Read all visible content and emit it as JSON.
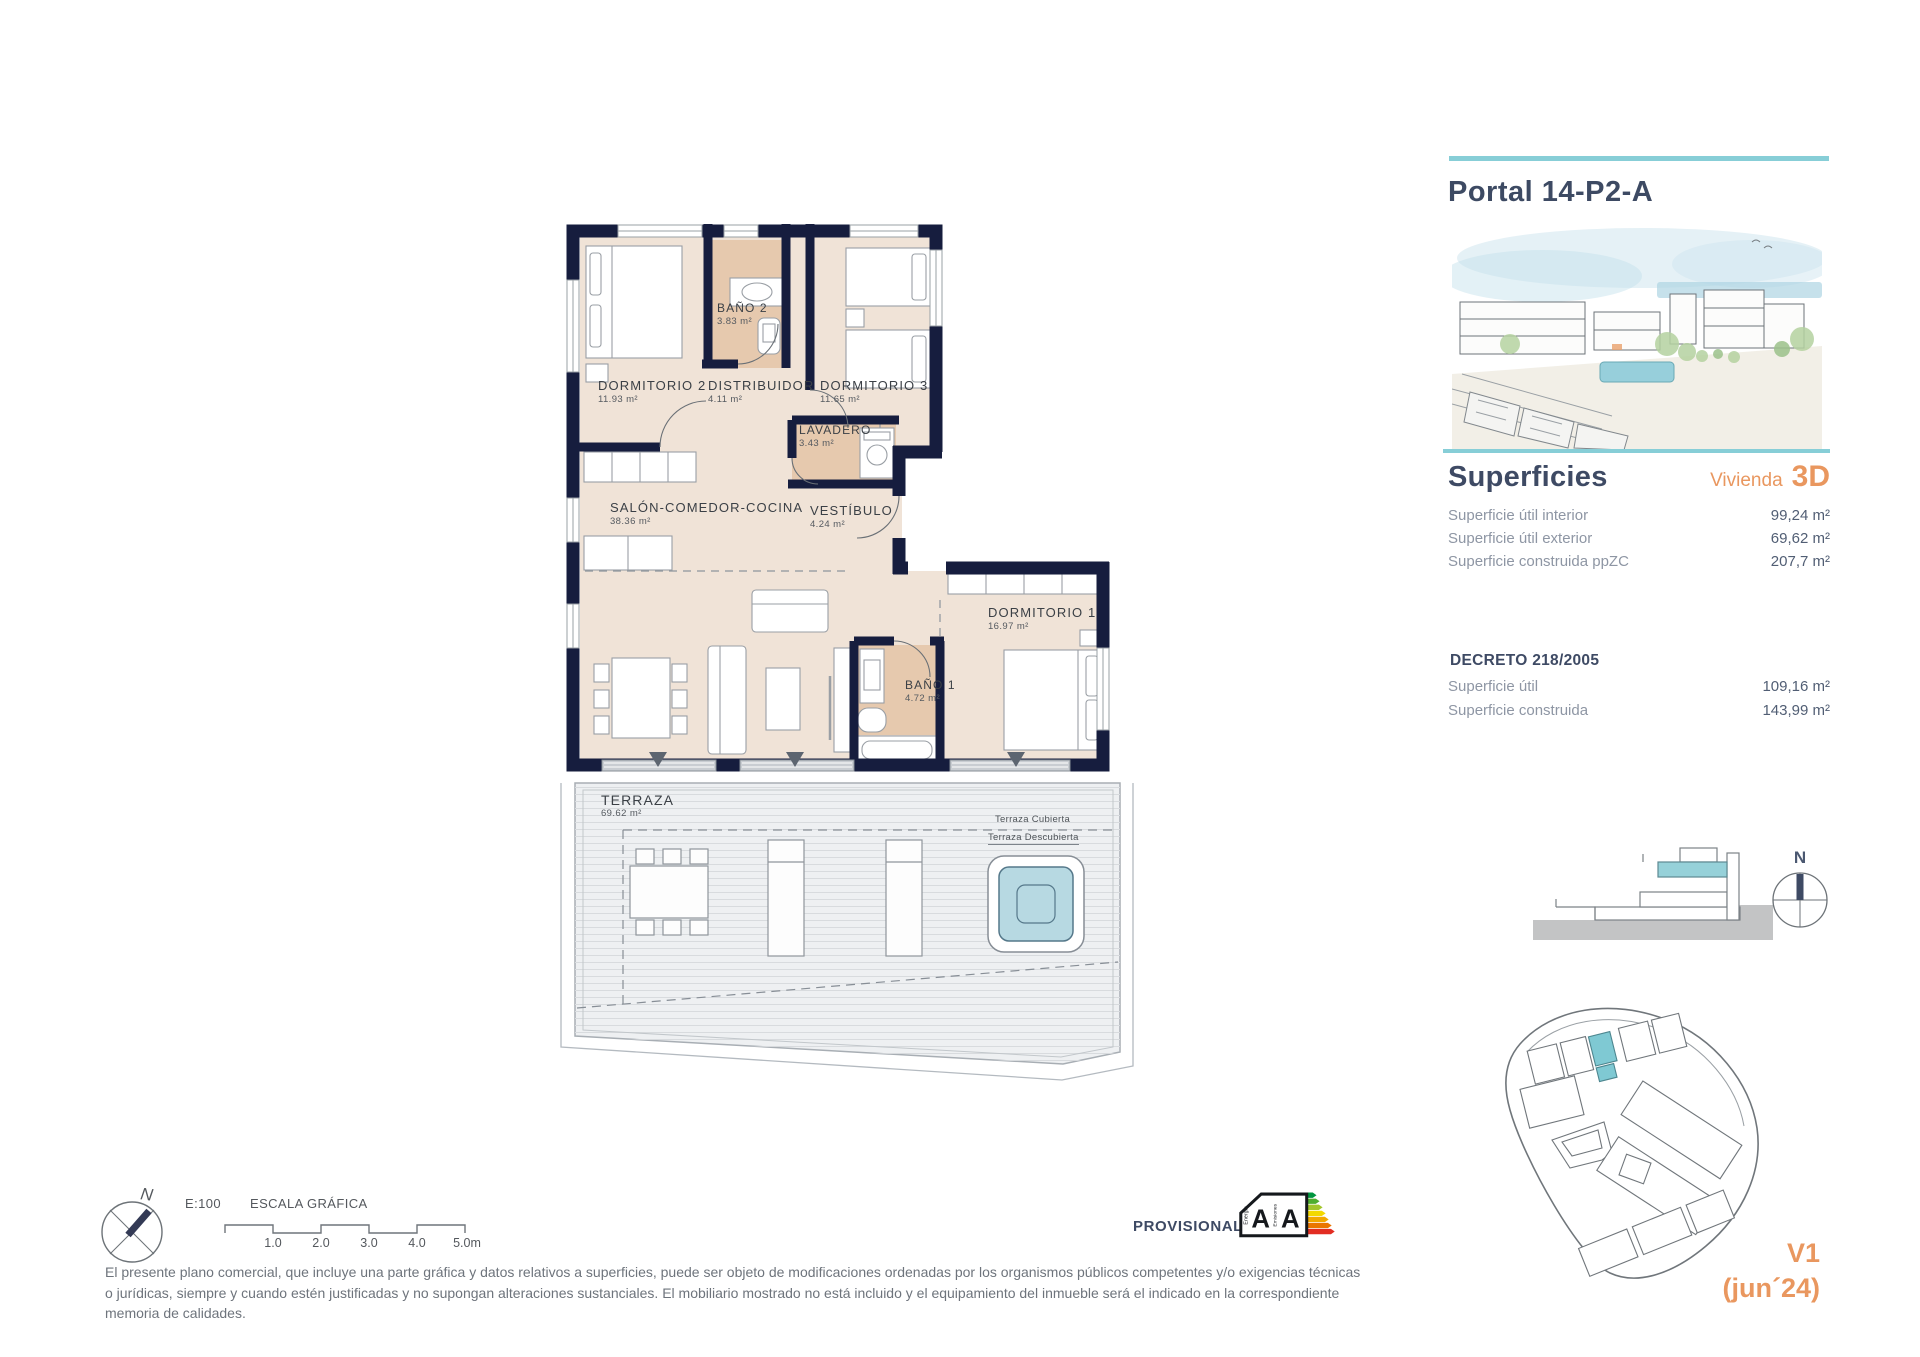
{
  "header": {
    "title": "Portal 14-P2-A"
  },
  "superficies": {
    "heading": "Superficies",
    "vivienda_label": "Vivienda",
    "vivienda_type": "3D",
    "rows": [
      {
        "label": "Superficie útil interior",
        "value": "99,24 m²"
      },
      {
        "label": "Superficie útil exterior",
        "value": "69,62 m²"
      },
      {
        "label": "Superficie construida ppZC",
        "value": "207,7 m²"
      }
    ]
  },
  "decreto": {
    "heading": "DECRETO 218/2005",
    "rows": [
      {
        "label": "Superficie útil",
        "value": "109,16 m²"
      },
      {
        "label": "Superficie construida",
        "value": "143,99 m²"
      }
    ]
  },
  "plan": {
    "rooms": [
      {
        "name": "DORMITORIO 2",
        "area": "11.93 m²"
      },
      {
        "name": "BAÑO 2",
        "area": "3.83 m²"
      },
      {
        "name": "DISTRIBUIDOR",
        "area": "4.11 m²"
      },
      {
        "name": "DORMITORIO 3",
        "area": "11.65 m²"
      },
      {
        "name": "LAVADERO",
        "area": "3.43 m²"
      },
      {
        "name": "SALÓN-COMEDOR-COCINA",
        "area": "38.36 m²"
      },
      {
        "name": "VESTÍBULO",
        "area": "4.24 m²"
      },
      {
        "name": "DORMITORIO 1",
        "area": "16.97 m²"
      },
      {
        "name": "BAÑO 1",
        "area": "4.72 m²"
      }
    ],
    "terraza": {
      "name": "TERRAZA",
      "area": "69.62 m²"
    },
    "terrace_division": {
      "above": "Terraza Cubierta",
      "below": "Terraza Descubierta"
    }
  },
  "scale_bar": {
    "ratio": "E:100",
    "title": "ESCALA GRÁFICA",
    "ticks": [
      "1.0",
      "2.0",
      "3.0",
      "4.0",
      "5.0m"
    ]
  },
  "compass": {
    "north": "N"
  },
  "energy_label": {
    "provisional": "PROVISIONAL",
    "energia": "Energía",
    "emisiones": "Emisiones",
    "rating_energy": "A",
    "rating_emissions": "A"
  },
  "disclaimer": "El presente plano comercial, que incluye una parte gráfica y datos relativos a superficies, puede ser objeto de modificaciones ordenadas por los organismos públicos competentes y/o exigencias técnicas o jurídicas, siempre y cuando estén justificadas y no supongan alteraciones sustanciales. El mobiliario mostrado no está incluido y el equipamiento del inmueble será el indicado en la correspondiente memoria de calidades.",
  "version": {
    "code": "V1",
    "date": "(jun´24)"
  }
}
